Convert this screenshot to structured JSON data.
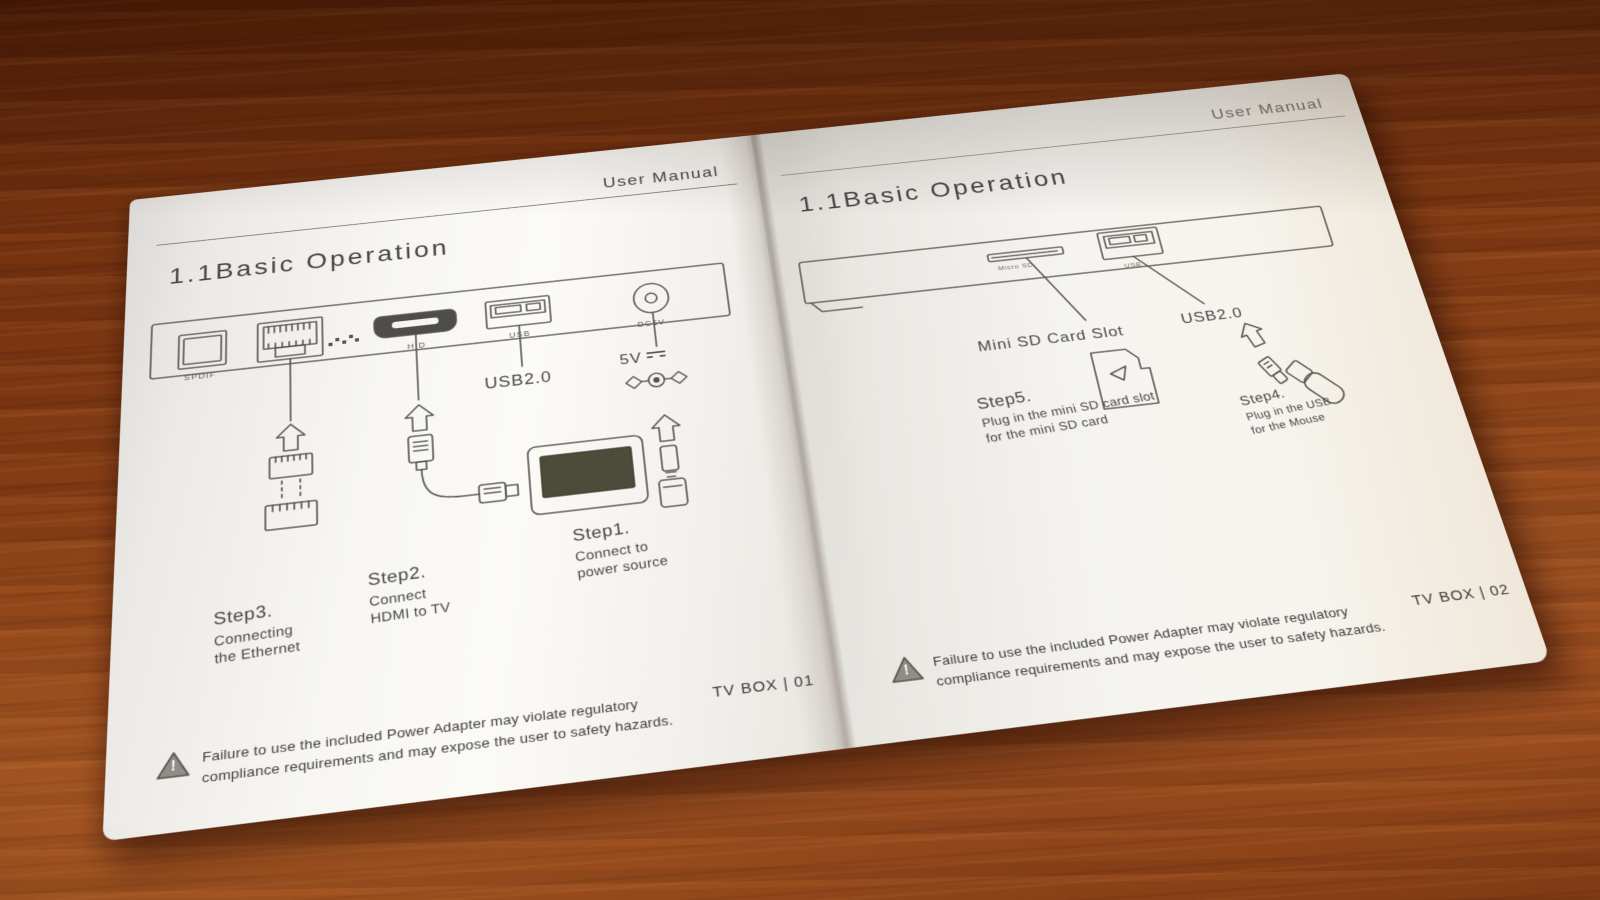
{
  "colors": {
    "wood": "#7c3712",
    "paper": "#f6f4f0",
    "ink": "#55534f",
    "tv_screen": "#4c4c3a"
  },
  "left_page": {
    "header": "User Manual",
    "title": "1.1Basic Operation",
    "port_labels": {
      "spdif": "SPDIF",
      "hdmi": "H D",
      "usb": "USB",
      "dc": "DC5V"
    },
    "callouts": {
      "usb2": "USB2.0",
      "power_voltage": "5V"
    },
    "steps": {
      "step1": {
        "name": "Step1.",
        "line1": "Connect to",
        "line2": "power source"
      },
      "step2": {
        "name": "Step2.",
        "line1": "Connect",
        "line2": "HDMI to TV"
      },
      "step3": {
        "name": "Step3.",
        "line1": "Connecting",
        "line2": "the Ethernet"
      }
    },
    "warning_symbol": "!",
    "warning_line1": "Failure to use the included Power Adapter may violate regulatory",
    "warning_line2": "compliance requirements and may expose the user to safety hazards.",
    "page_number": "TV BOX | 01"
  },
  "right_page": {
    "header": "User Manual",
    "title": "1.1Basic Operation",
    "port_labels": {
      "micro_sd": "Micro SD",
      "usb": "USB"
    },
    "callouts": {
      "sd_slot": "Mini SD Card Slot",
      "usb2": "USB2.0"
    },
    "steps": {
      "step5": {
        "name": "Step5.",
        "line1": "Plug in the mini SD card slot",
        "line2": "for the mini SD card"
      },
      "step4": {
        "name": "Step4.",
        "line1": "Plug in the USB",
        "line2": "for the Mouse"
      }
    },
    "warning_symbol": "!",
    "warning_line1": "Failure to use the included Power Adapter may violate regulatory",
    "warning_line2": "compliance requirements and may expose the user to safety hazards.",
    "page_number": "TV BOX | 02"
  }
}
